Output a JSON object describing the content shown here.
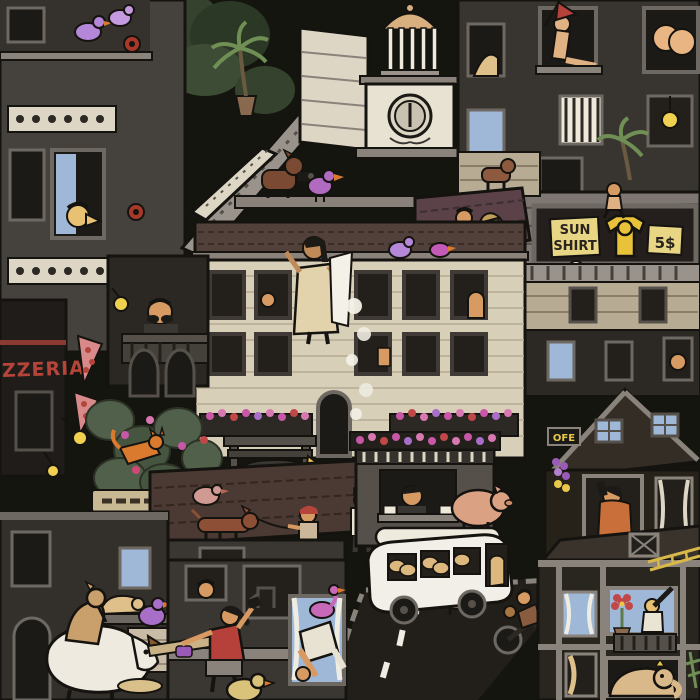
{
  "scene": {
    "type": "illustration",
    "subject": "Dense hand-drawn ink cityscape teeming with tiny characters, animals and shops",
    "palette": {
      "background": "#14150f",
      "ink": "#15130f",
      "stone_light": "#ddd6c4",
      "facade_tan": "#d8cfb8",
      "gray_mid": "#6e6862",
      "gray_light": "#9a938c",
      "building_dark": "#2c2823",
      "roof_brown": "#52403a",
      "window_blue": "#9fb8d8",
      "lamp_yellow": "#f0d050",
      "sign_yellow": "#e8d070",
      "accent_red": "#b5453a",
      "accent_magenta": "#c857a8",
      "accent_purple": "#a86fc8",
      "skin_tan": "#d79a62",
      "plant_green": "#5d7a4d",
      "van_white": "#f2efe8"
    },
    "signs": {
      "sun_shirt_line1": "SUN",
      "sun_shirt_line2": "SHIRT",
      "sun_shirt_price": "5$",
      "pizzeria_partial": "ZZERIA",
      "cheese_label": "CHEESE",
      "news_kiosk": "NEWS",
      "cafe_sign_partial": "OFE"
    },
    "clock_time": "6:00",
    "elements": [
      "woman shaking a blanket off a rooftop ledge with dust falling",
      "clock tower with domed cupola",
      "rooftop billboard selling sun shirts for 5$",
      "pizzeria sign with pizza slices on the wall",
      "cheese tub stand with a rat underneath",
      "newsstand vendor behind counter",
      "white van loaded with bread on the street",
      "pigs, dachshund on a leash, orange cat, purple pigeons",
      "white goat with a dog on its back",
      "woman in red exercising on a rooftop",
      "man with telescope at a balcony window",
      "elephant seen through a ground-floor window",
      "person climbing out of a curtained window",
      "motorcyclist riding down the road",
      "man with backpack scrambling over a roof",
      "man on the phone in a gabled attic window",
      "bare backside sticking out of a top-right window",
      "balcony man with moustache under a yellow lamp"
    ]
  }
}
